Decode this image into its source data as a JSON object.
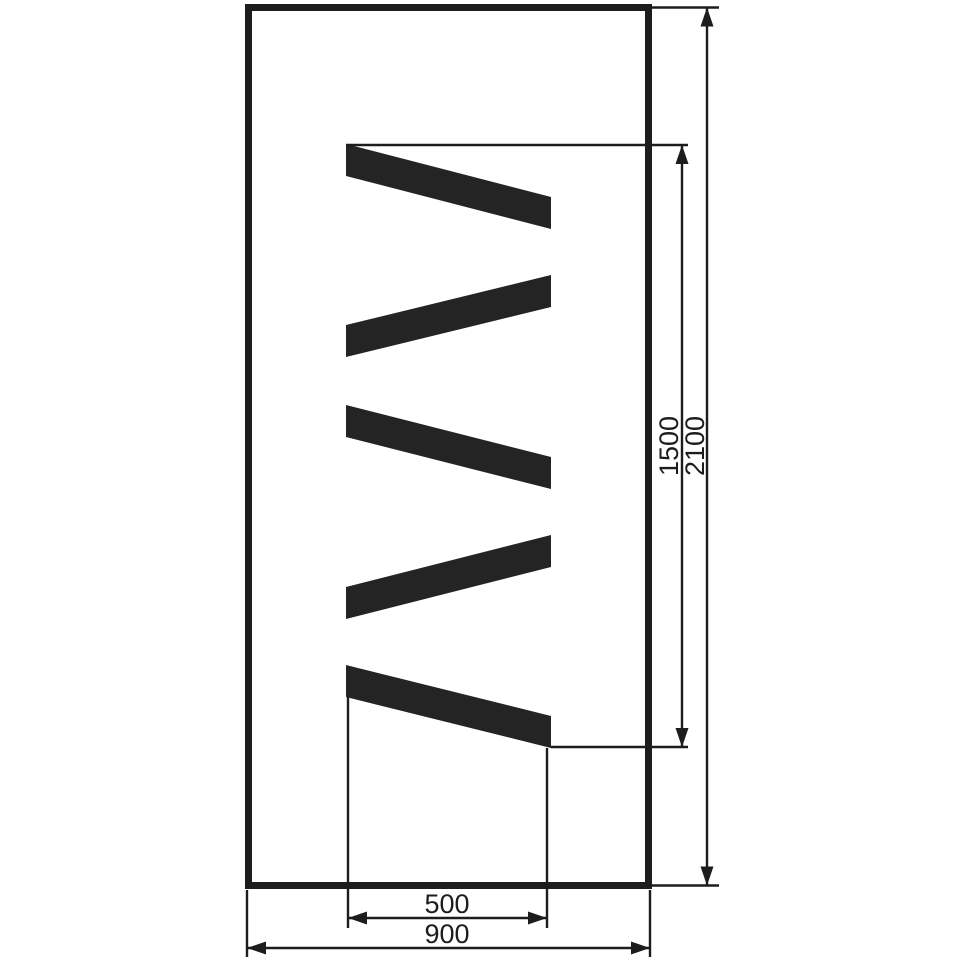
{
  "drawing": {
    "kind": "technical-drawing",
    "colors": {
      "line": "#1d1d1d",
      "bar": "#242424",
      "background": "#ffffff"
    },
    "dimensions": {
      "zigzag_height": "1500",
      "total_height": "2100",
      "opening_width": "500",
      "total_width": "900"
    }
  }
}
